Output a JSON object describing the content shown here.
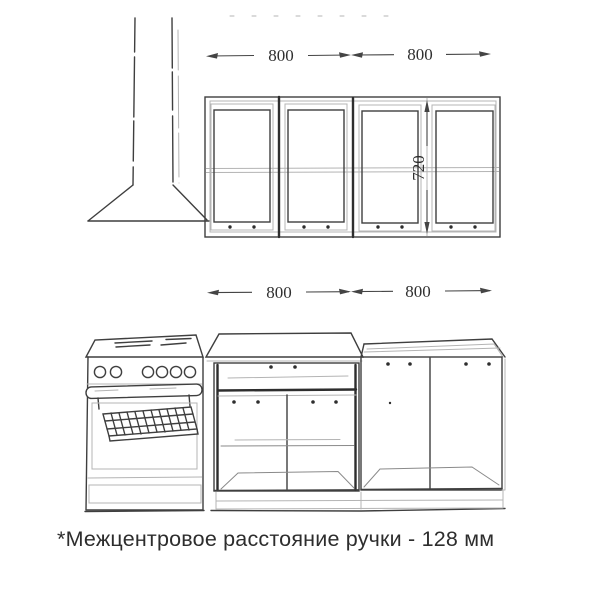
{
  "title": "Kitchen set elevation drawing",
  "dimensions": {
    "upper": {
      "left_width": "800",
      "right_width": "800",
      "cabinet_height": "720"
    },
    "lower": {
      "left_width": "800",
      "right_width": "800"
    }
  },
  "note": {
    "text": "*Межцентровое расстояние ручки - 128 мм"
  },
  "colors": {
    "background": "#ffffff",
    "line_dark": "#3f3f3f",
    "line_light": "#b4b4b4",
    "dimension": "#444444",
    "note_text": "#2d2d2d"
  }
}
